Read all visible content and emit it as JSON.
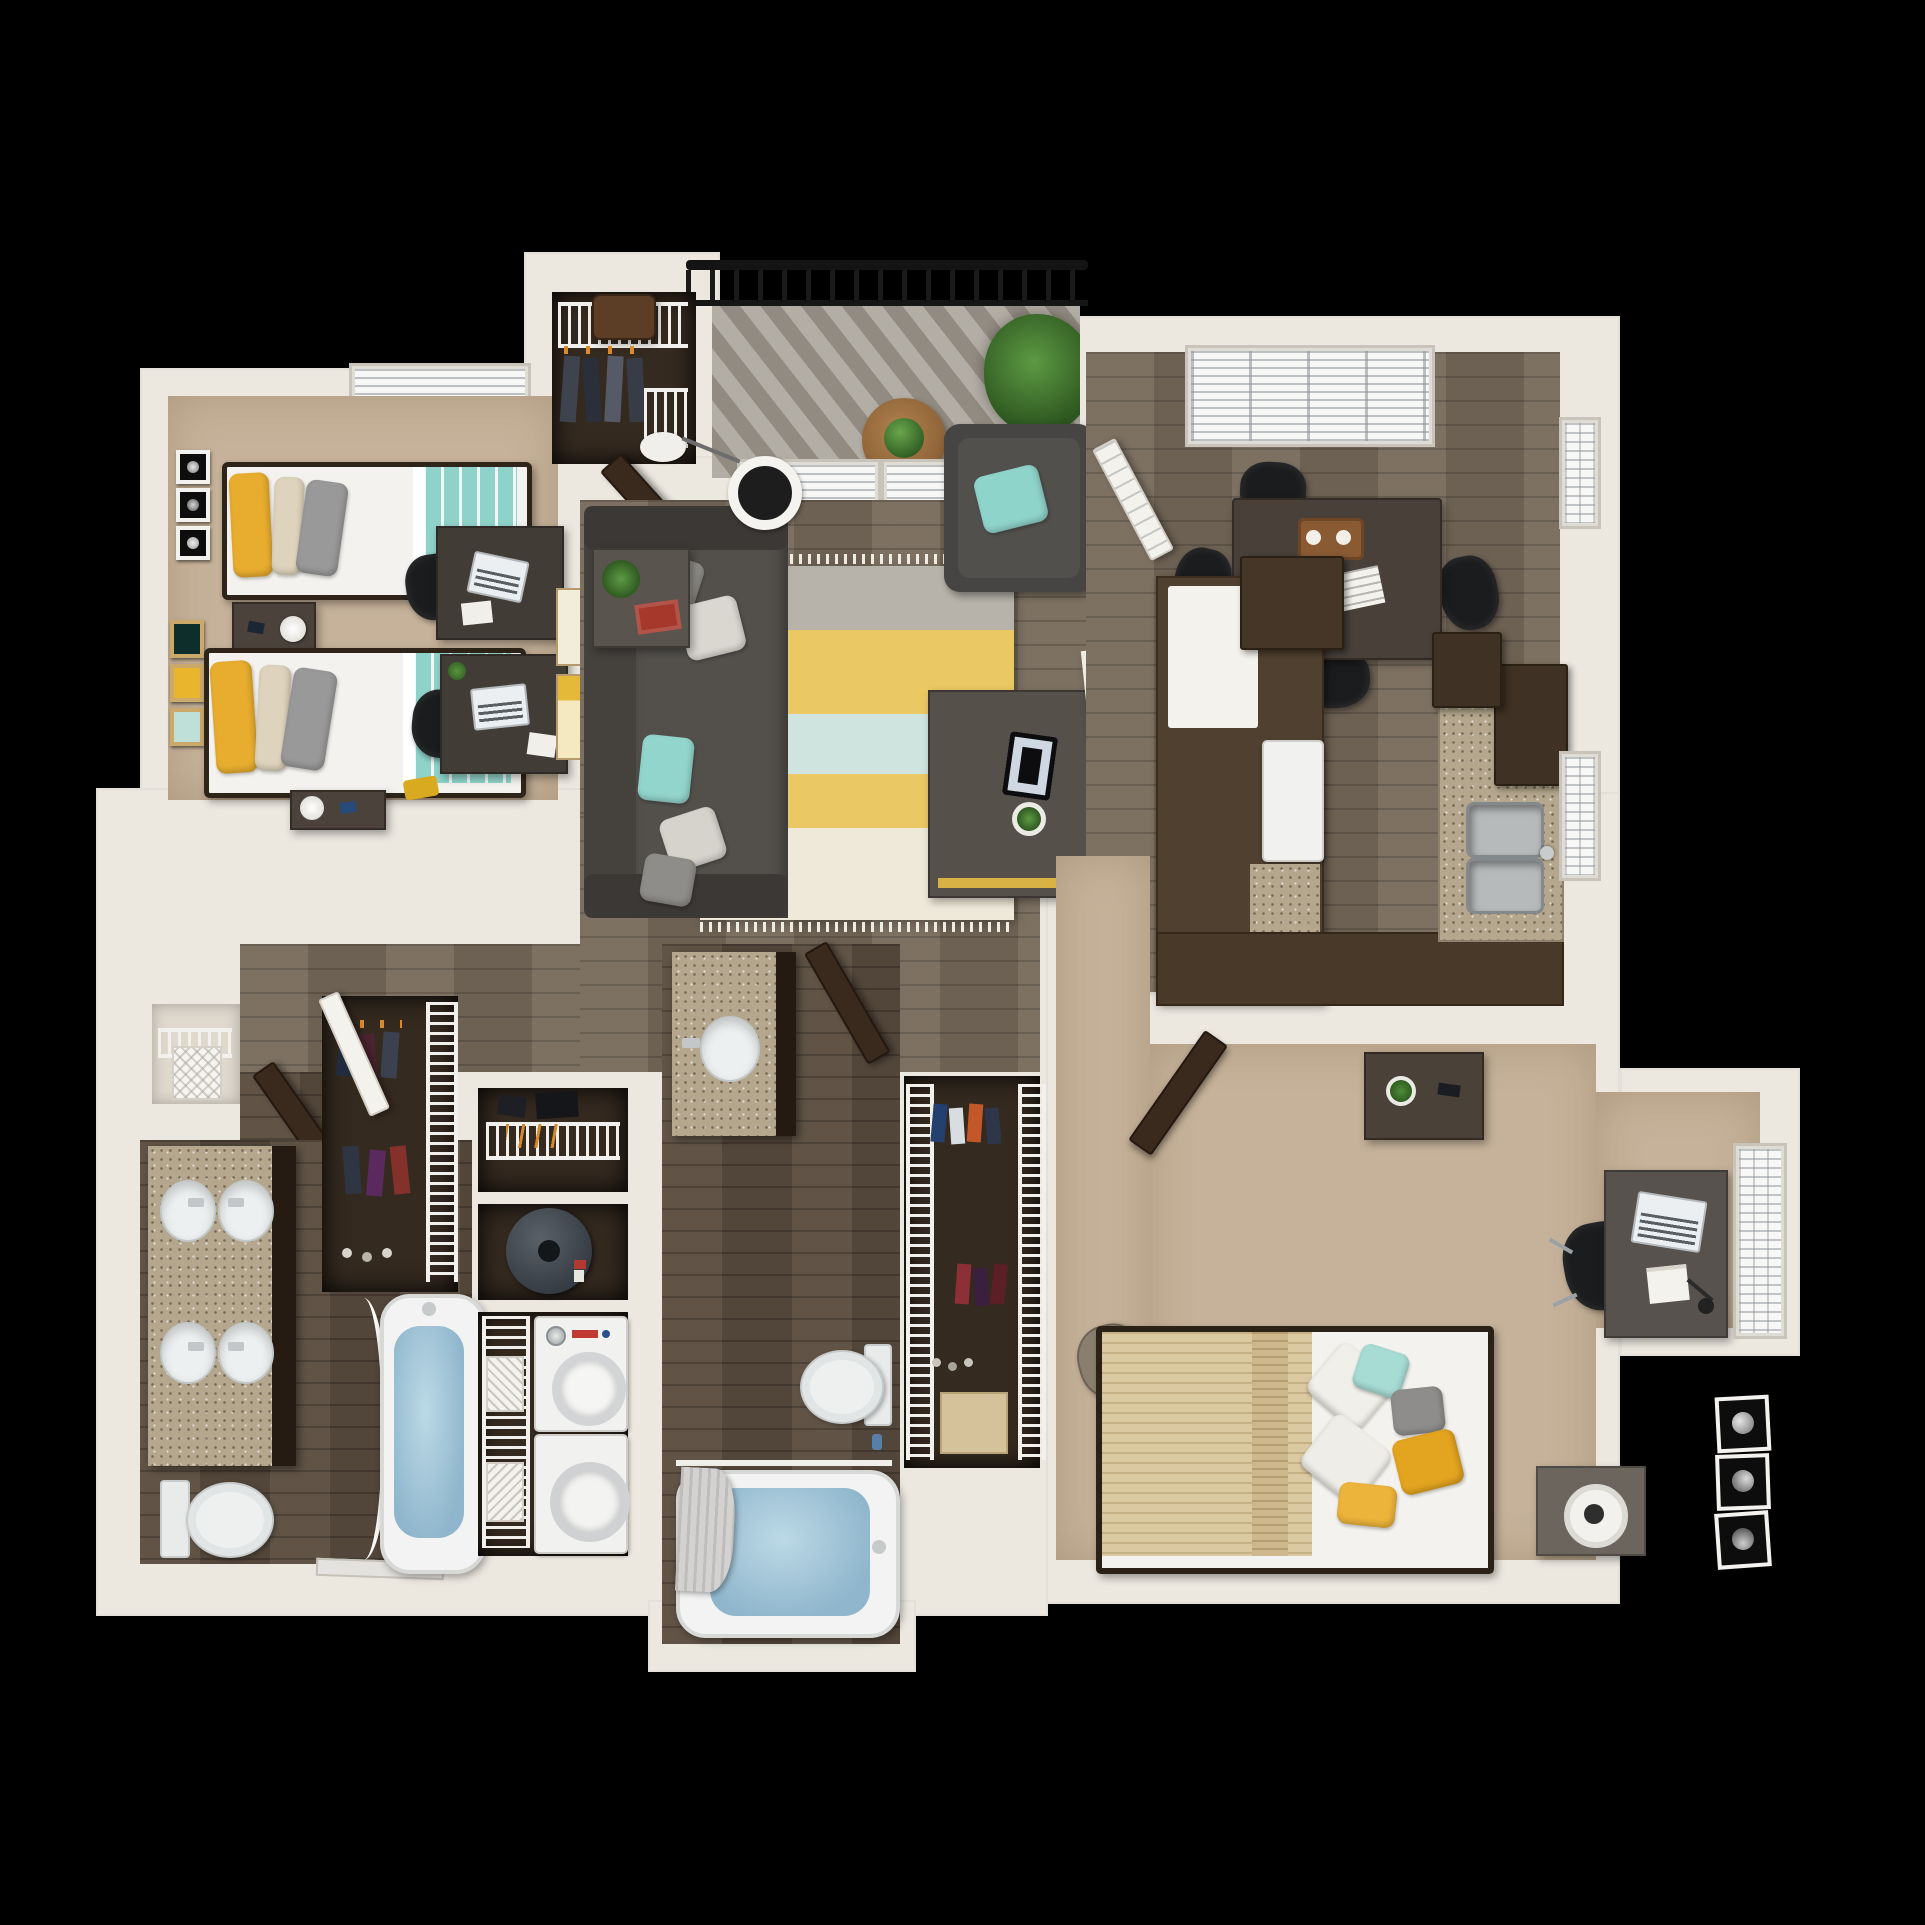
{
  "scene": {
    "type": "3d-floor-plan-render",
    "description": "Top-down 3D render of a two-bedroom apartment floor plan on a black background"
  },
  "labels": {
    "fireplace": "Fireplace"
  },
  "palette": {
    "background": "#000000",
    "walls": "#ece8e0",
    "wood_floor": "#76695a",
    "bath_wood_floor": "#5b4d3f",
    "carpet": "#c6b29a",
    "closet_floor": "#352a20",
    "deck": "#9e978c",
    "granite": "#b4a78e",
    "cabinet_brown": "#50402f",
    "sofa_gray": "#4f4c48",
    "teal_accent": "#8fd2c9",
    "yellow_accent": "#e8ad2e",
    "water_blue": "#96bed2",
    "railing_black": "#161616"
  }
}
